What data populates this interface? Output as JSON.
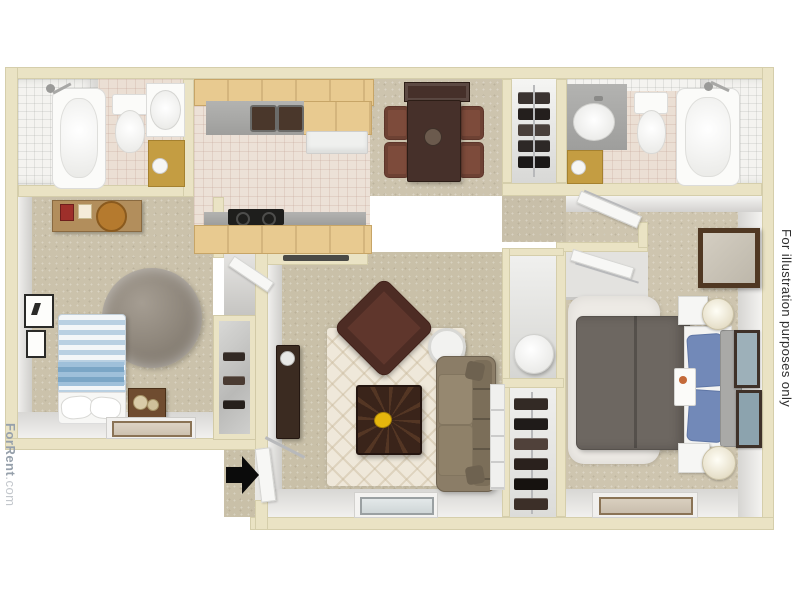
{
  "image": {
    "kind": "3D rendered apartment floor plan, top-down view",
    "source_brand": "ForRent.com"
  },
  "watermarks": {
    "left_brand": "ForRent",
    "left_suffix": ".com",
    "right_disclaimer": "For illustration purposes only"
  },
  "palette": {
    "background": "#ffffff",
    "exterior_wall": "#eae3c4",
    "carpet": "#cbc2ab",
    "tile_floor": "#ebdfd4",
    "cabinet_wood": "#e8ca90",
    "counter_gray": "#a8a8a6",
    "dark_wood_furniture": "#46302a",
    "sofa_taupe": "#8b7d67",
    "bed_comforter_gray": "#6d6761",
    "pillow_blue": "#7289b8",
    "striped_bed_blue": "#b9d0e2",
    "entry_arrow": "#0b0b0b"
  },
  "floorplan": {
    "rooms": [
      {
        "name": "bathroom-top-left",
        "furniture": [
          "bathtub with shower",
          "toilet",
          "sink vanity",
          "gold cabinet"
        ]
      },
      {
        "name": "kitchen",
        "furniture": [
          "L-shaped wood cabinets",
          "double sink",
          "refrigerator",
          "range with cooktop",
          "pass-through counter"
        ]
      },
      {
        "name": "dining-area",
        "furniture": [
          "rectangular table",
          "four chairs",
          "buffet cabinet",
          "centerpiece"
        ]
      },
      {
        "name": "hall-closet",
        "furniture": [
          "hanging clothes",
          "closet rod"
        ]
      },
      {
        "name": "bathroom-top-right",
        "furniture": [
          "sink vanity",
          "toilet",
          "bathtub with shower"
        ]
      },
      {
        "name": "bedroom-left",
        "furniture": [
          "blue striped bed with pillows",
          "round shag rug",
          "dresser with decor",
          "nightstand with candles",
          "two wall pictures",
          "window"
        ]
      },
      {
        "name": "bedroom-left-closet",
        "furniture": [
          "mirrored closet",
          "shoe shelves"
        ]
      },
      {
        "name": "living-room",
        "furniture": [
          "patterned area rug",
          "sofa",
          "leather armchair",
          "square coffee table with yellow bowl",
          "round side table",
          "media cabinet",
          "white shelf unit",
          "window",
          "entry door"
        ]
      },
      {
        "name": "linen-closet",
        "furniture": [
          "round laundry hamper"
        ]
      },
      {
        "name": "shoe-closet",
        "furniture": [
          "shoe rack"
        ]
      },
      {
        "name": "bedroom-right",
        "furniture": [
          "bed with gray comforter and blue pillows",
          "headboard bench",
          "two nightstands with lamps",
          "white shag rug",
          "wall mirror",
          "two framed pictures",
          "sliding-door closet",
          "window"
        ]
      },
      {
        "name": "entry",
        "furniture": [
          "black entry arrow",
          "open front door"
        ]
      }
    ]
  }
}
